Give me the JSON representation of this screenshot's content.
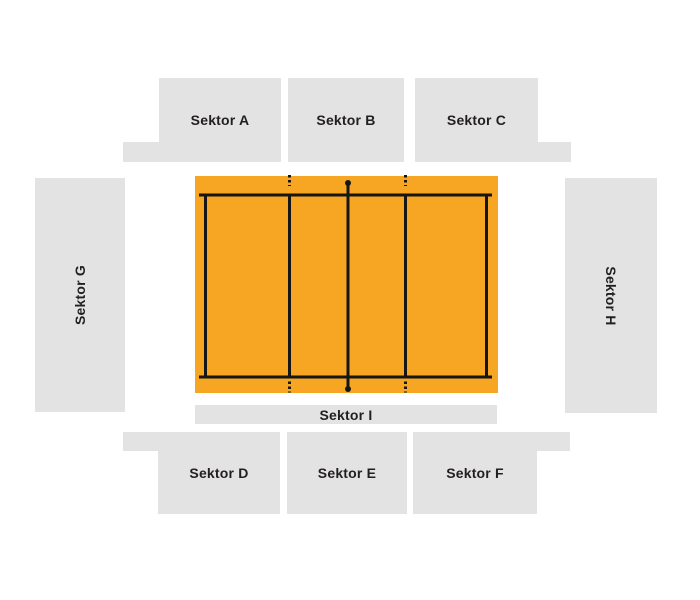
{
  "colors": {
    "background": "#ffffff",
    "sector_fill": "#e3e3e3",
    "court_fill": "#f6a623",
    "court_line": "#161616",
    "label_color": "#231f20"
  },
  "court": {
    "type": "volleyball-court-top-view",
    "elements": [
      "boundary lines",
      "attack lines with dotted extensions",
      "center net line with post dots"
    ]
  },
  "sectors": {
    "a": {
      "label": "Sektor A"
    },
    "b": {
      "label": "Sektor B"
    },
    "c": {
      "label": "Sektor C"
    },
    "d": {
      "label": "Sektor D"
    },
    "e": {
      "label": "Sektor E"
    },
    "f": {
      "label": "Sektor F"
    },
    "g": {
      "label": "Sektor G"
    },
    "h": {
      "label": "Sektor H"
    },
    "i": {
      "label": "Sektor I"
    }
  }
}
